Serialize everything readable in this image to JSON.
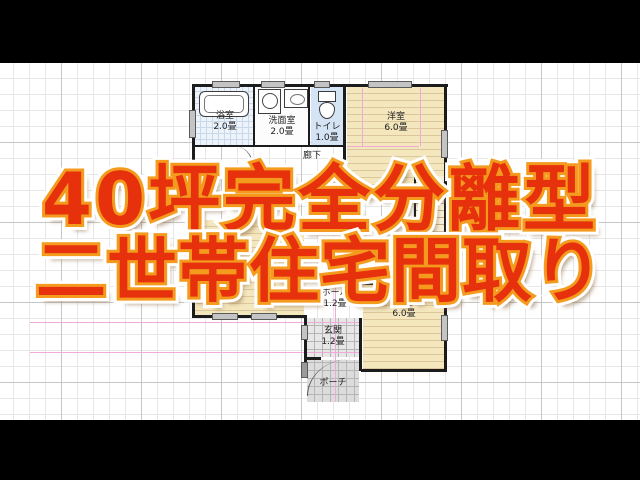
{
  "title": {
    "line1": "40坪完全分離型",
    "line2": "二世帯住宅間取り"
  },
  "colors": {
    "title_fill": "#e7300c",
    "title_outline": "#f49b1e",
    "title_glow": "#ffffff",
    "title_shadow": "rgba(140,104,66,0.55)",
    "wall": "#1c1c1c",
    "room_wood_beige": "#f4e6bd",
    "wet_area_blue": "#d5e4f5",
    "entrance_tile_gray": "#e7e7e7",
    "module_grid_pink": "#eeaad9",
    "paper_grid_major": "#c6c6c6",
    "paper_grid_minor": "#e7e7e7"
  },
  "floor_plan": {
    "rooms": [
      {
        "label": "浴室",
        "size": "2.0畳"
      },
      {
        "label": "洗面室",
        "size": "2.0畳"
      },
      {
        "label": "トイレ",
        "size": "1.0畳"
      },
      {
        "label": "洋室",
        "size": "6.0畳"
      },
      {
        "label": "廊下",
        "size": ""
      },
      {
        "label": "クロゼット",
        "size": "1.5畳"
      },
      {
        "label": "ホール",
        "size": "1.2畳"
      },
      {
        "label": "玄関",
        "size": "1.2畳"
      },
      {
        "label": "ポーチ",
        "size": ""
      },
      {
        "label": "洋室",
        "size": "6.0畳"
      }
    ],
    "fixtures": [
      "bathtub",
      "washing-machine",
      "washbasin",
      "toilet",
      "staircase"
    ]
  }
}
